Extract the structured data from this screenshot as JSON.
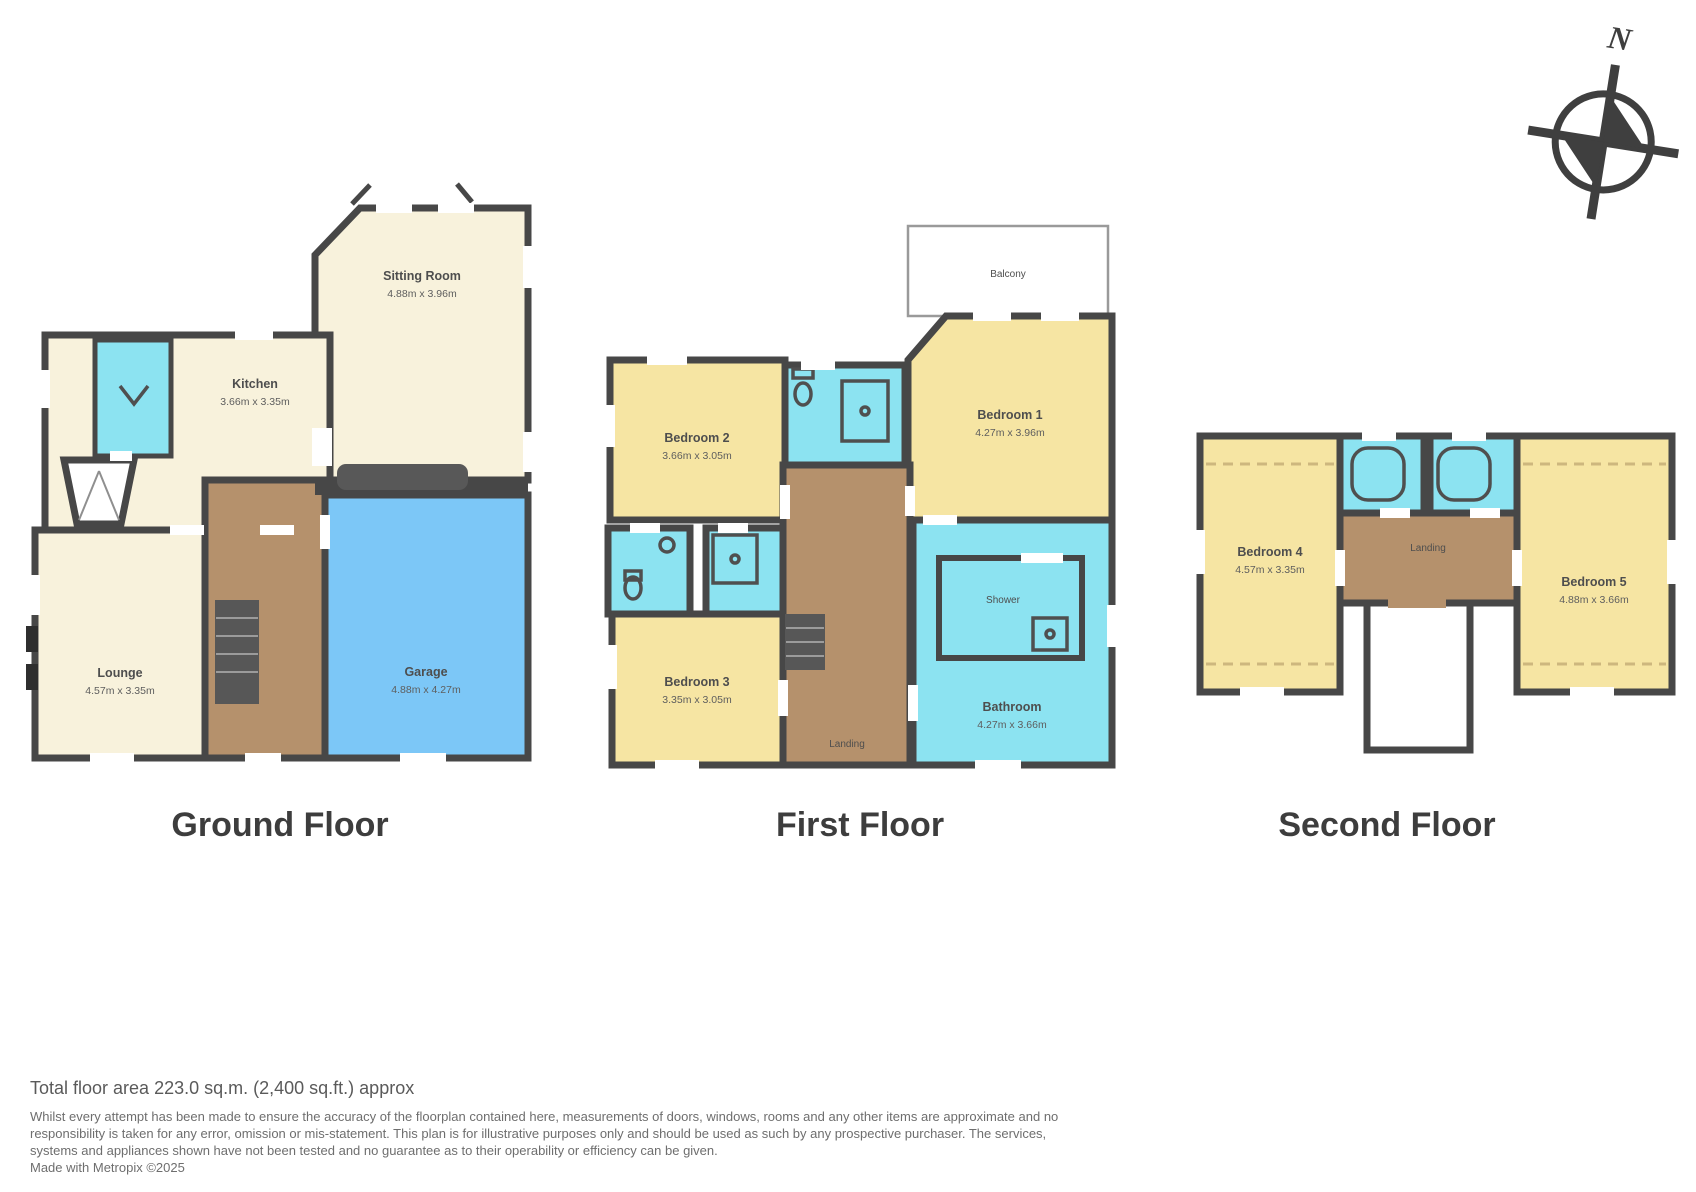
{
  "colors": {
    "wall": "#474747",
    "cream": "#f8f2dc",
    "yellow": "#f6e5a3",
    "cyan": "#8ce3f1",
    "brown": "#b5916c",
    "blue": "#7cc7f7",
    "fixture": "#4f4f4f",
    "eaves": "#cdb77e",
    "title": "#3d3d3d"
  },
  "compass": {
    "north_label": "N"
  },
  "floors": {
    "ground": {
      "title": "Ground Floor",
      "rooms": {
        "sitting": {
          "name": "Sitting Room",
          "dims": "4.88m x 3.96m"
        },
        "kitchen": {
          "name": "Kitchen",
          "dims": "3.66m x 3.35m"
        },
        "lounge": {
          "name": "Lounge",
          "dims": "4.57m x 3.35m"
        },
        "garage": {
          "name": "Garage",
          "dims": "4.88m x 4.27m"
        }
      }
    },
    "first": {
      "title": "First Floor",
      "rooms": {
        "balcony": {
          "name": "Balcony"
        },
        "bedroom1": {
          "name": "Bedroom 1",
          "dims": "4.27m x 3.96m"
        },
        "bedroom2": {
          "name": "Bedroom 2",
          "dims": "3.66m x 3.05m"
        },
        "bedroom3": {
          "name": "Bedroom 3",
          "dims": "3.35m x 3.05m"
        },
        "bathroom": {
          "name": "Bathroom",
          "dims": "4.27m x 3.66m"
        },
        "shower": {
          "name": "Shower"
        },
        "landing": {
          "name": "Landing"
        }
      }
    },
    "second": {
      "title": "Second Floor",
      "rooms": {
        "bedroom4": {
          "name": "Bedroom 4",
          "dims": "4.57m x 3.35m"
        },
        "bedroom5": {
          "name": "Bedroom 5",
          "dims": "4.88m x 3.66m"
        },
        "landing": {
          "name": "Landing"
        }
      }
    }
  },
  "footer": {
    "total_area": "Total floor area 223.0 sq.m. (2,400 sq.ft.) approx",
    "disclaimer": "Whilst every attempt has been made to ensure the accuracy of the floorplan contained here, measurements of doors, windows, rooms and any other items are approximate and no responsibility is taken for any error, omission or mis-statement. This plan is for illustrative purposes only and should be used as such by any prospective purchaser. The services, systems and appliances shown have not been tested and no guarantee as to their operability or efficiency can be given.",
    "credit": "Made with Metropix ©2025"
  }
}
